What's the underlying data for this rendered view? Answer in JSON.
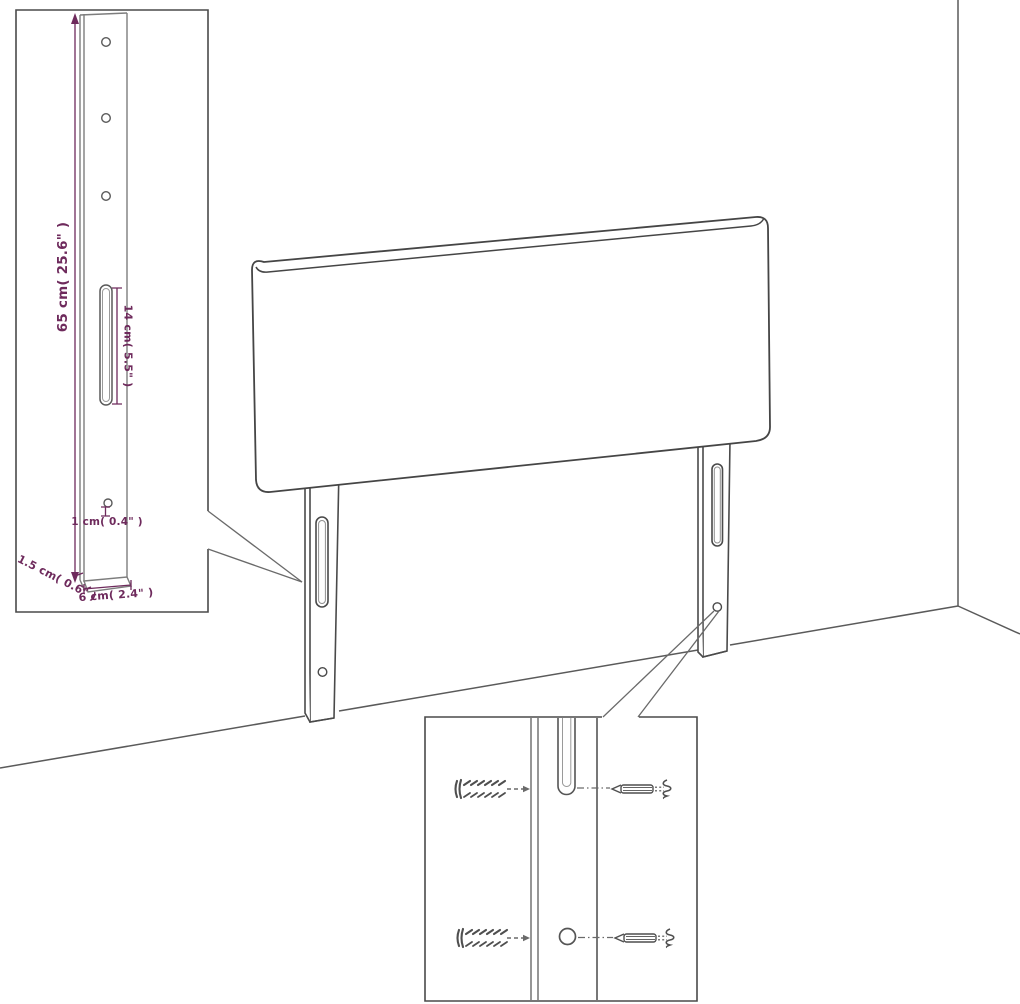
{
  "diagram": {
    "type": "headboard-assembly-dimension-diagram",
    "background": "#ffffff",
    "colors": {
      "line": "#4a4a4a",
      "line_light": "#8f8f8f",
      "dimension": "#6e2a5c"
    },
    "labels": {
      "leg_height": "65 cm( 25.6\" )",
      "slot_length": "14 cm( 5.5\" )",
      "hole_size": "1 cm( 0.4\" )",
      "leg_thickness": "1.5 cm( 0.6\" )",
      "leg_width": "6 cm( 2.4\" )"
    },
    "parts": {
      "panel": "headboard-panel",
      "legs": "mounting-legs",
      "fasteners": [
        "wall-plug",
        "screw"
      ]
    }
  }
}
